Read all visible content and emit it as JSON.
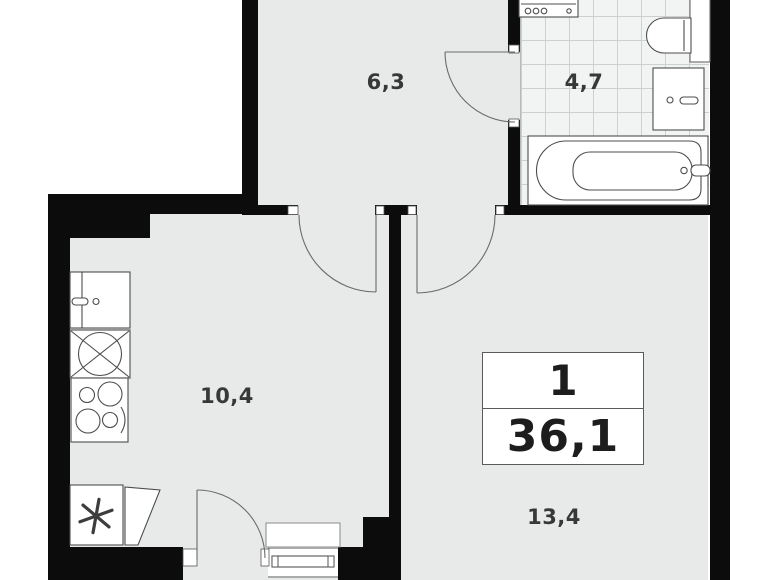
{
  "floorplan": {
    "type": "apartment-floor-plan",
    "rooms": [
      {
        "id": "hallway",
        "area_label": "6,3"
      },
      {
        "id": "bathroom",
        "area_label": "4,7"
      },
      {
        "id": "kitchen",
        "area_label": "10,4"
      },
      {
        "id": "living-room",
        "area_label": "13,4"
      }
    ],
    "info_box": {
      "rooms_count": "1",
      "total_area": "36,1"
    },
    "fixtures": [
      "washing-machine-top-icon",
      "toilet-icon",
      "bathroom-sink-icon",
      "bathtub-icon",
      "vent-duct-icon",
      "kitchen-sink-icon",
      "washing-machine-icon",
      "stove-icon",
      "fridge-icon",
      "door-swing-icon",
      "window-icon",
      "window-sill-icon"
    ],
    "colors": {
      "wall": "#0c0c0c",
      "floor": "#e8eaea",
      "tile_floor": "#f2f3f3",
      "tile_grid": "#ccd0d1",
      "fixture_line": "#4d4d4d",
      "text": "#383838"
    }
  }
}
